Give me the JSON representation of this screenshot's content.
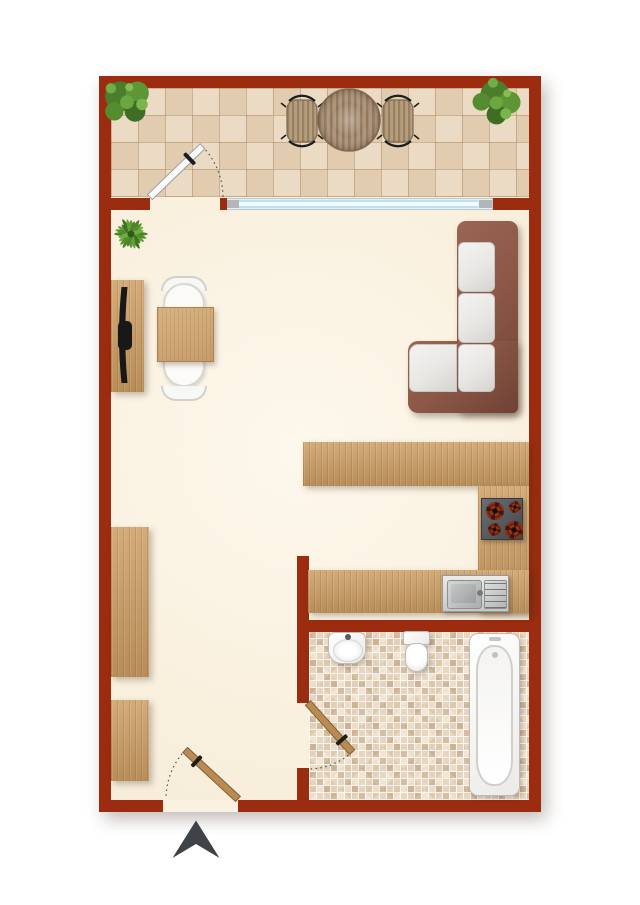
{
  "meta": {
    "description": "top-down apartment floor plan, no text labels"
  },
  "colors": {
    "page_bg": "#ffffff",
    "wall": "#9b2c10",
    "floor": "#faf1e0",
    "balcony_tile": "#e8d5ba",
    "mosaic_tile": "#e9d7bd",
    "wood": "#d3ac7a",
    "wood_dark": "#b78d58",
    "door_wood": "#b98a52",
    "sofa_frame": "#8b5747",
    "sofa_frame_dark": "#6f4234",
    "cushion": "#e9e7e4",
    "window_glass": "#cde9f3",
    "window_cap": "#b2b6b8",
    "stove": "#53565a",
    "burner": "#7c2a16",
    "plant": "#5e9636",
    "arrow": "#3f4347",
    "white_fixture": "#fcfcfb",
    "steel": "#c7c9cb"
  },
  "rooms": [
    {
      "name": "balcony",
      "items": [
        "potted-plant-left",
        "potted-plant-right",
        "patio-table",
        "patio-chair-left",
        "patio-chair-right",
        "balcony-door",
        "window"
      ]
    },
    {
      "name": "living-room",
      "items": [
        "palm-plant",
        "tv-sideboard",
        "tv",
        "dining-table",
        "dining-chair-top",
        "dining-chair-bottom",
        "corner-sofa"
      ]
    },
    {
      "name": "kitchen",
      "items": [
        "counter-top",
        "counter-right",
        "counter-bottom",
        "cooktop-4-burner",
        "double-sink"
      ]
    },
    {
      "name": "bathroom",
      "items": [
        "wash-basin",
        "toilet",
        "bathtub",
        "bathroom-door"
      ]
    },
    {
      "name": "entry",
      "items": [
        "wardrobe-tall",
        "wardrobe-small",
        "entrance-door",
        "entrance-arrow"
      ]
    }
  ]
}
